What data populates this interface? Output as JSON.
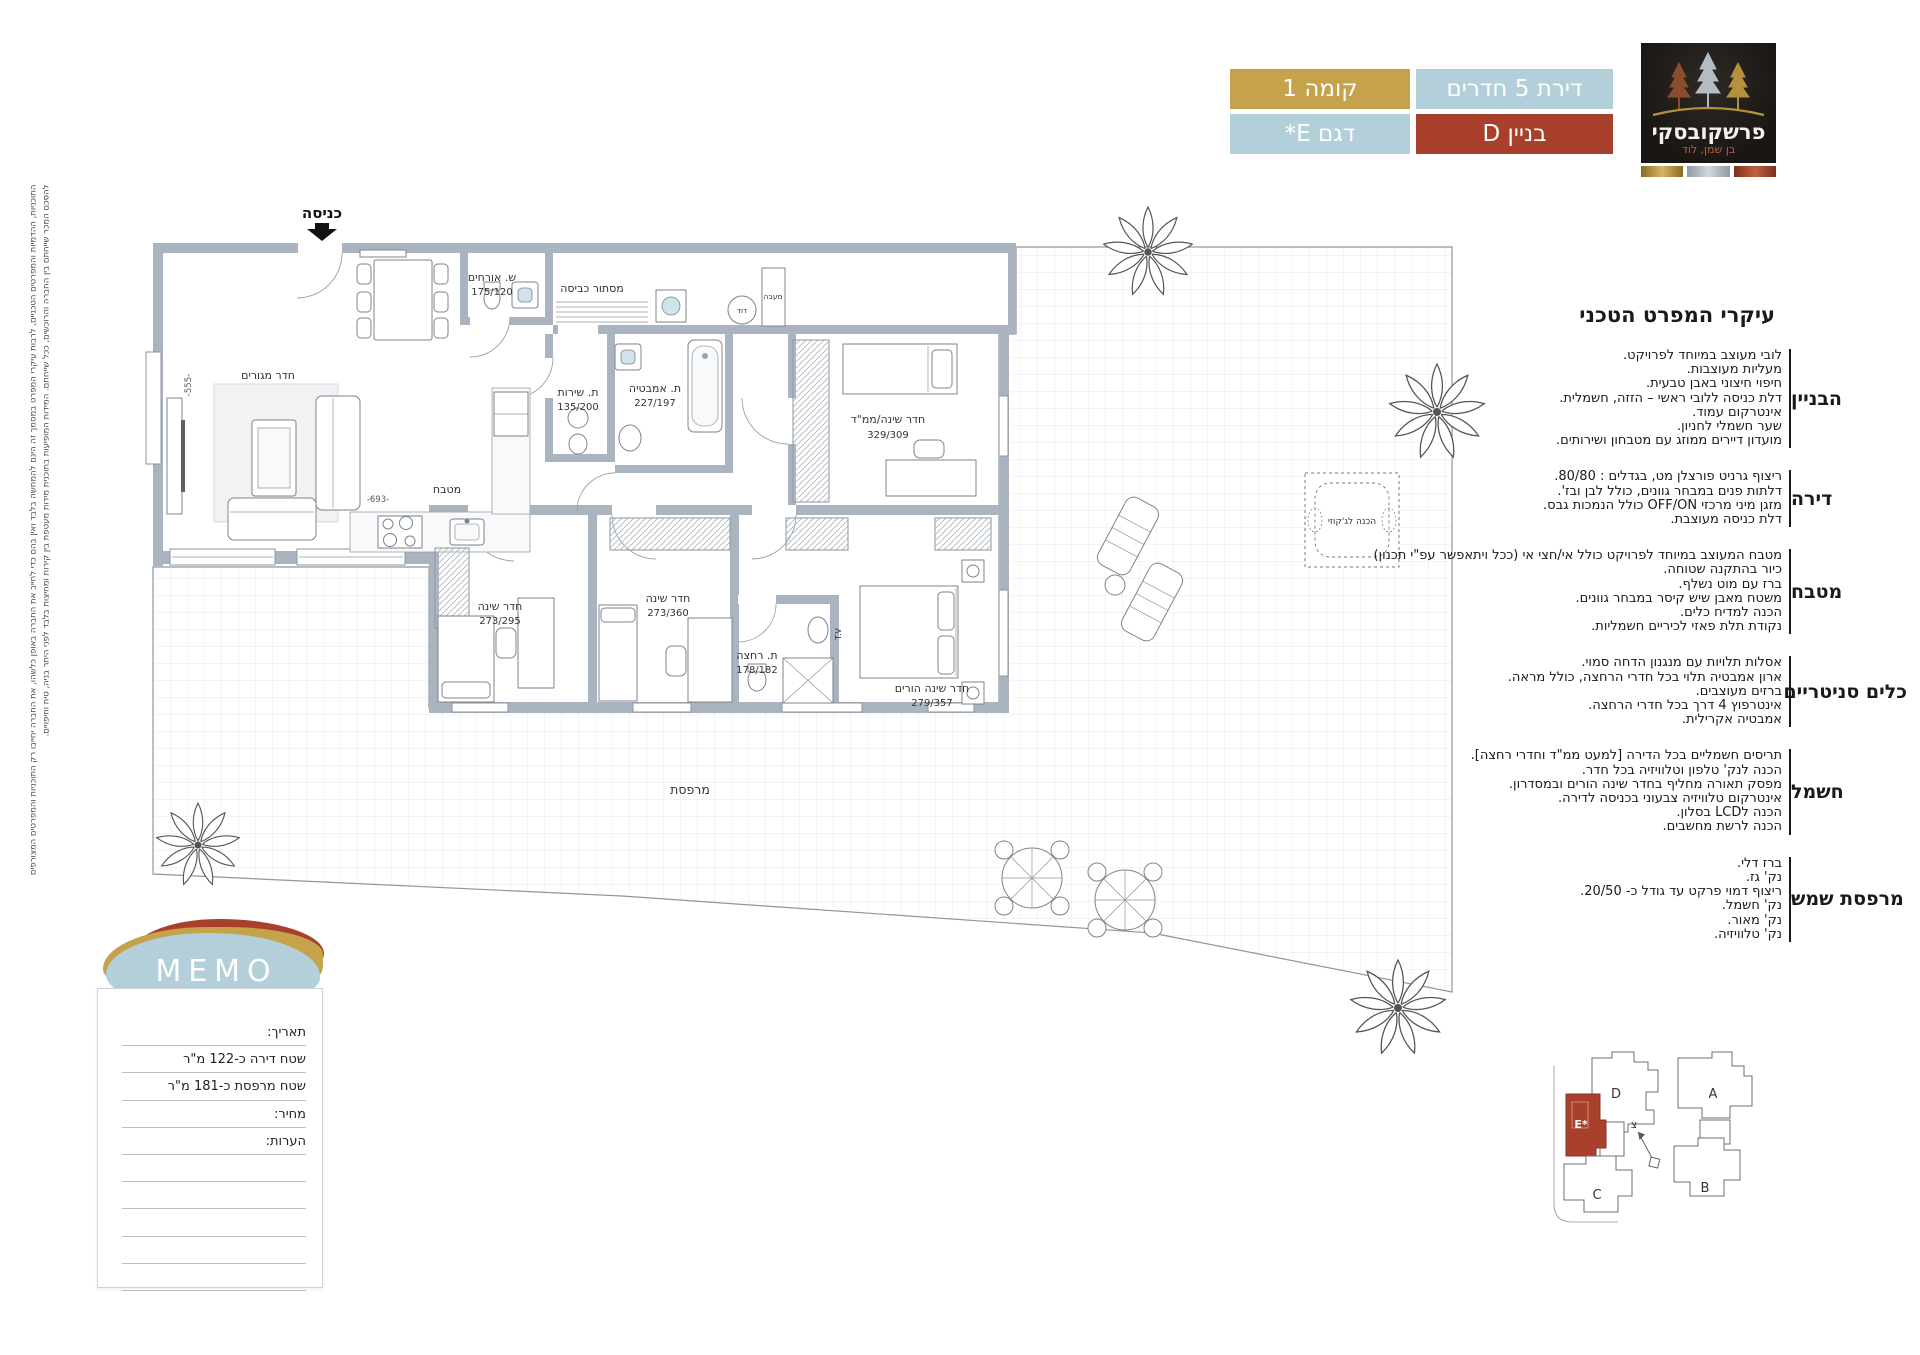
{
  "header": {
    "badges": {
      "rooms": "דירת 5 חדרים",
      "building": "בניין D",
      "floor": "קומה 1",
      "model": "דגם E*"
    },
    "logo": {
      "brand": "פרשקובסקי",
      "location": "בן שמן, לוד"
    },
    "colors": {
      "gold": "#c6a24b",
      "blue": "#b2cfda",
      "red": "#a8402c",
      "logo_bg": "#1b1815"
    }
  },
  "specs": {
    "title": "עיקרי המפרט הטכני",
    "sections": [
      {
        "heading": "הבניין",
        "lines": [
          "לובי מעוצב במיוחד לפרויקט.",
          "מעליות מעוצבות.",
          "חיפוי חיצוני באבן טבעית.",
          "דלת כניסה ללובי ראשי – הזזה, חשמלית.",
          "אינטרקום עמוד.",
          "שער חשמלי לחניון.",
          "מועדון דיירים ממוזג עם מטבחון ושירותים."
        ]
      },
      {
        "heading": "דירה",
        "lines": [
          "ריצוף גרניט פורצלן מט, בגדלים : 80/80.",
          "דלתות פנים במבחר גוונים, כולל לבן ובז'.",
          "מזגן מיני מרכזי OFF/ON כולל הנמכות גבס.",
          "דלת כניסה מעוצבת."
        ]
      },
      {
        "heading": "מטבח",
        "lines": [
          "מטבח המעוצב במיוחד לפרויקט כולל אי/חצי אי (ככל ויתאפשר עפ\"י תכנון)",
          "כיור בהתקנה שטוחה.",
          "ברז עם מוט נשלף.",
          "משטח מאבן שיש קיסר במבחר גוונים.",
          "הכנה למדיח כלים.",
          "נקודת תלת פאזי לכיריים חשמליות."
        ]
      },
      {
        "heading": "כלים סניטריים",
        "lines": [
          "אסלות תלויות עם מנגנון הדחה סמוי.",
          "ארון אמבטיה תלוי בכל חדרי הרחצה, כולל מראה.",
          "ברזים מעוצבים.",
          "אינטרפוץ 4 דרך בכל חדרי הרחצה.",
          "אמבטיה אקרילית."
        ]
      },
      {
        "heading": "חשמל",
        "lines": [
          "תריסים חשמליים בכל הדירה [למעט ממ\"ד וחדרי רחצה].",
          "הכנה לנק' טלפון וטלוויזיה בכל חדר.",
          "מפסק תאורה מחליף בחדר שינה הורים ובמסדרון.",
          "אינטרקום טלוויזיה צבעוני בכניסה לדירה.",
          "הכנה לLCD בסלון.",
          "הכנה לרשת מחשבים."
        ]
      },
      {
        "heading": "מרפסת שמש",
        "lines": [
          "ברז דלי.",
          "נק' גז.",
          "ריצוף דמוי פרקט עד גודל כ- 20/50.",
          "נק' חשמל.",
          "נק' מאור.",
          "נק' טלוויזיה."
        ]
      }
    ]
  },
  "memo": {
    "title": "MEMO",
    "fields": [
      "תאריך:",
      "שטח דירה כ-122 מ\"ר",
      "שטח מרפסת כ-181 מ\"ר",
      "מחיר:",
      "הערות:"
    ]
  },
  "plan": {
    "entrance": "כניסה",
    "rooms": {
      "living": {
        "name": "חדר מגורים"
      },
      "kitchen": {
        "name": "מטבח"
      },
      "guest_wc": {
        "name": "ש. אורחים",
        "dim": "175/120"
      },
      "laundry": {
        "name": "מסתור כביסה"
      },
      "boiler": {
        "name": "דוד"
      },
      "condenser": {
        "name": "מעבה"
      },
      "service_wc": {
        "name": "ת. שירות",
        "dim": "135/200"
      },
      "bathroom": {
        "name": "ת. אמבטיה",
        "dim": "227/197"
      },
      "mamad": {
        "name": "חדר שינה/ממ\"ד",
        "dim": "329/309"
      },
      "bedroom2": {
        "name": "חדר שינה",
        "dim": "273/295"
      },
      "bedroom3": {
        "name": "חדר שינה",
        "dim": "273/360"
      },
      "shower": {
        "name": "ת. רחצה",
        "dim": "178/182"
      },
      "master": {
        "name": "חדר שינה הורים",
        "dim": "279/357"
      },
      "terrace": {
        "name": "מרפסת"
      }
    },
    "labels": {
      "jacuzzi": "הכנה לג'קוזי",
      "tv": "T.V"
    },
    "dims": {
      "living_v": "-555-",
      "living_h": "-693-"
    }
  },
  "siteplan": {
    "buildings": {
      "a": "A",
      "b": "B",
      "c": "C",
      "d": "D",
      "e": "E*"
    },
    "north": "צ",
    "highlight_color": "#a8402c"
  },
  "disclaimer": {
    "line1": "התוכניות, ההדמיות והמפרטים הטכניים, לרבות עיקרי המפרט במסמך זה הינם להמחשה בלבד ואין בהם כדי לחייב את החברה באופן כלשהו, את החברה יחייבו רק התוכניות והמפרטים המצורפים",
    "line2": "להסכם המכר שייחתם בין החברה והרוכשים, ככל שייחתם. המידות המופיעות בתוכנית מידות מעטפת בין קירות ומחיצות בלבד לפני היתר בניה, טיח וחיפויים."
  }
}
